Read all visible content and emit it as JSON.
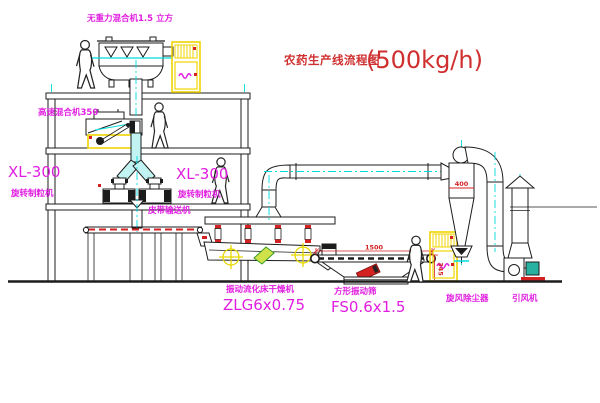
{
  "title": {
    "line_cn": "农药生产线流程图",
    "capacity": "(500kg/h)"
  },
  "labels": {
    "gravity_mixer": "无重力混合机1.5 立方",
    "high_speed_mixer": "高速混合机350",
    "xl_left_model": "XL-300",
    "xl_left_name": "旋转制粒机",
    "xl_right_model": "XL-300",
    "xl_right_name": "旋转制粒机",
    "belt_conveyor": "皮带输送机",
    "dryer_name": "振动流化床干燥机",
    "dryer_model": "ZLG6x0.75",
    "screen_name": "方形振动筛",
    "screen_model": "FS0.6x1.5",
    "cyclone": "旋风除尘器",
    "fan": "引风机"
  },
  "dimensions": {
    "screen_length": "1500",
    "screen_height": "345",
    "cyclone_dia": "400"
  },
  "colors": {
    "line_black": "#1c1c1c",
    "label_magenta": "#e01ee0",
    "title_red": "#cf2f2f",
    "dimension_red": "#d42222",
    "pipe_cyan": "#00dcdc",
    "cabinet_yellow": "#f0d400",
    "marker_yellow": "#e8d800",
    "fan_motor_teal": "#28b0a0",
    "inlet_green": "#3a9a28"
  }
}
